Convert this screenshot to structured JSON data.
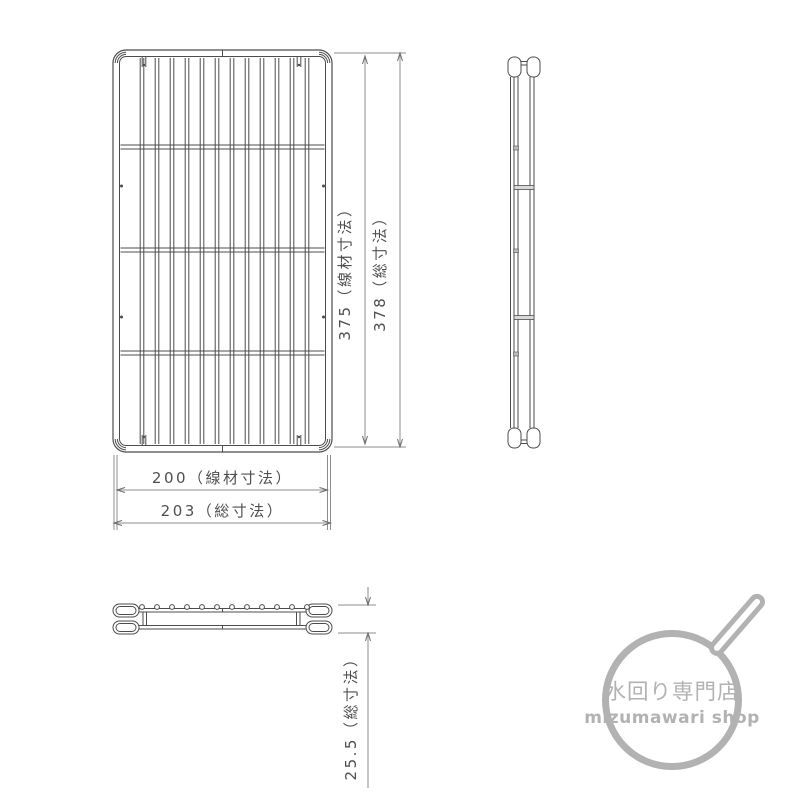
{
  "drawing": {
    "dimensions": {
      "height_wire": "375（線材寸法）",
      "height_total": "378（総寸法）",
      "width_wire": "200（線材寸法）",
      "width_total": "203（総寸法）",
      "depth_total": "25.5（総寸法）"
    },
    "values": {
      "height_wire_mm": 375,
      "height_total_mm": 378,
      "width_wire_mm": 200,
      "width_total_mm": 203,
      "depth_total_mm": 25.5
    }
  },
  "logo": {
    "title_jp": "水回り専門店",
    "subtitle_en": "mizumawari shop"
  },
  "colors": {
    "line": "#4c4c4c",
    "dimension_line": "#8c8c8c",
    "dimension_text": "#4f4f4f",
    "logo_gray": "#b2b2b2",
    "background": "#ffffff"
  }
}
